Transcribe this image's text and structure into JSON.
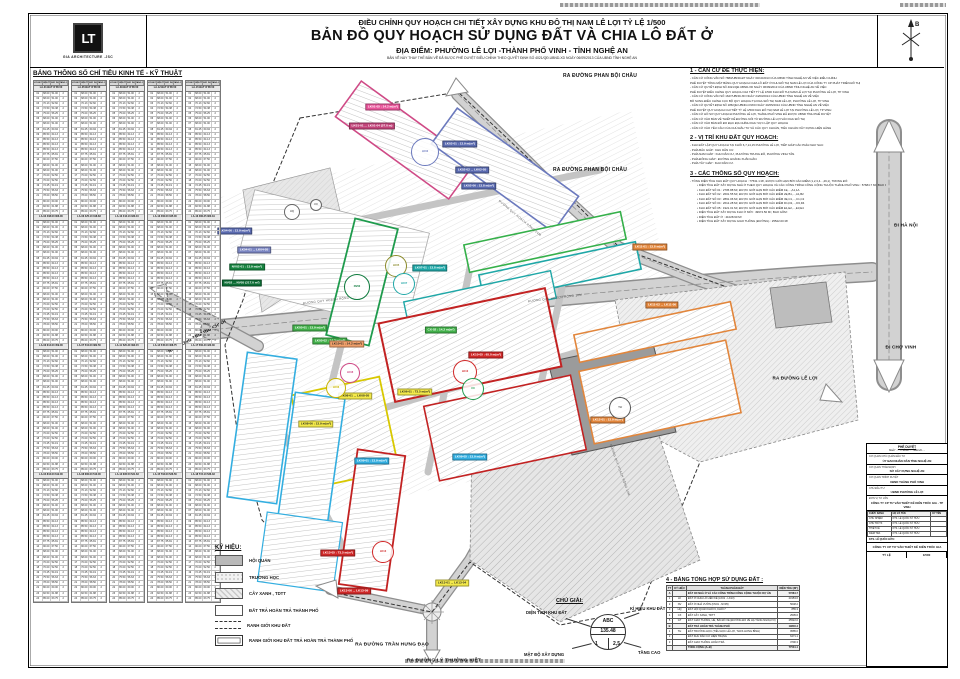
{
  "header": {
    "line1": "ĐIỀU CHỈNH QUY HOẠCH CHI TIẾT XÂY DỰNG KHU ĐÔ THỊ NAM LÊ LỢI TỶ LỆ 1/500",
    "line2": "BẢN ĐỒ QUY HOẠCH SỬ DỤNG ĐẤT VÀ CHIA LÔ ĐẤT Ở",
    "line3": "ĐỊA ĐIỂM: PHƯỜNG LÊ LỢI -THÀNH PHỐ VINH - TỈNH NGHỆ AN",
    "line4": "BẢN VẼ NÀY THAY THẾ BẢN VẼ ĐÃ ĐƯỢC PHÊ DUYỆT ĐIỀU CHỈNH THEO QUYẾT ĐỊNH SỐ 4021/QĐ.UBND-XD NGÀY 06/09/2013 CỦA UBND TỈNH NGHỆ AN"
  },
  "logo": {
    "glyph": "LT",
    "company": "GIA ARCHITECTURE .JSC"
  },
  "compass": {
    "north": "B"
  },
  "left_table": {
    "title": "BẢNG THÔNG SỐ CHỈ TIÊU KINH TẾ - KỸ THUẬT",
    "col_headers": [
      "LÔ ĐẤT",
      "DIỆN TÍCH (M²)",
      "XÂY DỰNG (M²)",
      "TẦNG CAO"
    ],
    "groups": [
      {
        "head": "LA-01 ĐẤT Ở 85.50",
        "subs": [
          "LA-02   408.00   306.00",
          "LA-03   612.00   459.00",
          "LA-04   816.00   612.00"
        ]
      },
      {
        "head": "LA-05 ĐẤT Ở 85.50",
        "subs": [
          "LA-06   425.10   318.83",
          "LA-07   510.00   382.50",
          "LA-08   680.00   510.00"
        ]
      },
      {
        "head": "LA-09 ĐẤT Ở 85.50",
        "subs": [
          "LA-10   444.13   333.10",
          "LA-11   520.20   390.15",
          "LA-12   695.50   521.63"
        ]
      },
      {
        "head": "LA-12 ĐẤT Ở 85.50",
        "subs": [
          "LA-13   460.00   345.00",
          "LA-14   545.00   408.75",
          "LA-15   702.00   526.50"
        ]
      },
      {
        "head": "LA-15 ĐẤT Ở 85.50",
        "subs": [
          "LA-16   480.25   360.19",
          "LA-17   560.40   420.30",
          "LA-18   715.10   536.33"
        ]
      }
    ],
    "rows": [
      [
        "01",
        "68.00",
        "51.00",
        "2"
      ],
      [
        "02",
        "68.00",
        "51.00",
        "2"
      ],
      [
        "03",
        "70.13",
        "52.60",
        "2"
      ],
      [
        "04",
        "72.50",
        "54.38",
        "2"
      ],
      [
        "05",
        "75.00",
        "56.25",
        "2"
      ],
      [
        "06",
        "68.00",
        "51.00",
        "2"
      ],
      [
        "07",
        "68.00",
        "51.00",
        "2"
      ],
      [
        "08",
        "81.25",
        "60.94",
        "2"
      ],
      [
        "09",
        "85.50",
        "64.13",
        "2"
      ],
      [
        "10",
        "85.50",
        "64.13",
        "2"
      ],
      [
        "11",
        "85.50",
        "64.13",
        "2"
      ],
      [
        "12",
        "85.50",
        "64.13",
        "2"
      ],
      [
        "13",
        "87.75",
        "65.81",
        "2"
      ],
      [
        "14",
        "90.00",
        "67.50",
        "2"
      ],
      [
        "15",
        "68.00",
        "51.00",
        "2"
      ],
      [
        "16",
        "68.00",
        "51.00",
        "2"
      ],
      [
        "17",
        "70.00",
        "52.50",
        "2"
      ],
      [
        "18",
        "70.00",
        "52.50",
        "2"
      ],
      [
        "19",
        "72.25",
        "54.19",
        "2"
      ],
      [
        "20",
        "75.50",
        "56.63",
        "2"
      ],
      [
        "21",
        "78.00",
        "58.50",
        "2"
      ],
      [
        "22",
        "80.00",
        "60.00",
        "2"
      ],
      [
        "23",
        "82.50",
        "61.88",
        "2"
      ],
      [
        "24",
        "85.00",
        "63.75",
        "2"
      ]
    ]
  },
  "notes": {
    "sections": [
      {
        "title": "1 - CĂN CỨ ĐỂ THỰC HIỆN:",
        "lines": [
          "- CĂN CỨ CÔNG VĂN SỐ 7883/UBND-ĐT NGÀY 30/10/2013 CỦA UBND TỈNH NGHỆ AN VỀ VIỆC ĐIỀU CHỈNH",
          "PHÊ DUYỆT TỔNG MẶT BẰNG QUY HOẠCH CHIA LÔ ĐẤT Ở KHU ĐÔ THỊ NAM LÊ LỢI CỦA CÔNG TY CP PHÁT TRIỂN ĐÔ THỊ",
          "- CĂN CỨ QUYẾT ĐỊNH SỐ 4021/QĐ.UBND-XD NGÀY 06/09/2013 CỦA UBND TỈNH NGHỆ AN VỀ VIỆC",
          "PHÊ DUYỆT ĐIỀU CHỈNH QUY HOẠCH CHI TIẾT TỶ LỆ 1/500 KHU ĐÔ THỊ NAM LÊ LỢI TẠI PHƯỜNG LÊ LỢI, TP VINH",
          "- CĂN CỨ CÔNG VĂN SỐ 1627/UBND-XD NGÀY 24/03/2014 CỦA UBND TỈNH NGHỆ AN VỀ VIỆC",
          "BỔ SUNG ĐIỀU CHỈNH CỤC BỘ QUY HOẠCH TẠI KHU ĐÔ THỊ NAM LÊ LỢI, PHƯỜNG LÊ LỢI, TP VINH",
          "- CĂN CỨ QUYẾT ĐỊNH SỐ 186/QĐ.UBND-CNXD NGÀY 20/05/2014 CỦA UBND TỈNH NGHỆ AN VỀ VIỆC",
          "PHÊ DUYỆT QUY HOẠCH CHI TIẾT TỶ LỆ 1/500 KHU ĐÔ THỊ NAM LÊ LỢI TẠI PHƯỜNG LÊ LỢI, TP VINH",
          "- CĂN CỨ HỒ SƠ QUY HOẠCH PHƯỜNG LÊ LỢI, THÀNH PHỐ VINH ĐÃ ĐƯỢC UBND TỈNH PHÊ DUYỆT",
          "- CĂN CỨ VÀO BẢN VẼ THIẾT KẾ ĐƯỜNG NỐI TỪ ĐƯỜNG LÊ LỢI VÀO KHU ĐÔ THỊ",
          "- CĂN CỨ VÀO BẢN ĐỒ ĐO ĐẠC ĐỊA CHÍNH KHU VỰC LẬP QUY HOẠCH",
          "- CĂN CỨ VÀO YÊU CẦU CỦA CHỦ ĐẦU TƯ VÀ CÁC QUY CHUẨN, TIÊU CHUẨN XÂY DỰNG HIỆN HÀNH"
        ]
      },
      {
        "title": "2 - VỊ TRÍ KHU ĐẤT QUY HOẠCH:",
        "lines": [
          "- KHU ĐẤT LẬP QUY HOẠCH TẠI KHỐI 6,7,14,15 PHƯỜNG LÊ LỢI, TIẾP GIÁP CÁC PHÍA NHƯ SAU:",
          "- PHÍA BẮC GIÁP : KHU DÂN CƯ.",
          "- PHÍA NAM GIÁP : KHU DÂN CƯ, PHƯỜNG TRUNG ĐÔ, PHƯỜNG VINH TÂN.",
          "- PHÍA ĐÔNG GIÁP : ĐƯỜNG HOÀNG XUÂN HÃN.",
          "- PHÍA TÂY GIÁP : KHU DÂN CƯ."
        ]
      },
      {
        "title": "3 - CÁC THÔNG SỐ QUY HOẠCH:",
        "lines": [
          "- TỔNG DIỆN TÍCH KHU ĐẤT QUY HOẠCH : 77531.1 M², ĐƯỢC GIỚI HẠN BỞI CÁC ĐIỂM (1,2,3,4...,49,1), TRONG ĐÓ:",
          "• DIỆN TÍCH ĐẤT XÂY DỰNG NHÀ Ở THEO QUY HOẠCH VÀ CÁC CÔNG TRÌNH CÔNG CỘNG THUỘC THÀNH PHỐ VINH : 57684.7 M², BAO GỒM 26 KHU ĐẤT:",
          "• KHU ĐẤT SỐ 01 : 2705.88 M², ĐƯỢC GIỚI HẠN BỞI CÁC ĐIỂM 1E,...,A1,1A",
          "• KHU ĐẤT SỐ 02 : 2601.55 M², ĐƯỢC GIỚI HẠN BỞI CÁC ĐIỂM 2E,B1,...,A1,B2",
          "• KHU ĐẤT SỐ 03 : 2891.06 M², ĐƯỢC GIỚI HẠN BỞI CÁC ĐIỂM 3E,C1,...,C1,C2",
          "• KHU ĐẤT SỐ 04 : 2612.28 M², ĐƯỢC GIỚI HẠN BỞI CÁC ĐIỂM D1,D2,...,D3,D4",
          "• KHU ĐẤT SỐ 05 : 1921.01 M², ĐƯỢC GIỚI HẠN BỞI CÁC ĐIỂM E1,E2,...,E3,E4",
          "• DIỆN TÍCH ĐẤT XÂY DỰNG KHU Ở MỚI : 49974.50 M², BAO GỒM:",
          "• DIỆN TÍCH ĐẤT Ở : 41028.90 M²",
          "• DIỆN TÍCH ĐẤT XÂY DỰNG GIAO THÔNG (ĐƯỜNG) : 25522.00 M²"
        ]
      }
    ]
  },
  "legend": {
    "title": "KÝ HIỆU:",
    "items": [
      {
        "style": "solid",
        "label": "HỘI QUÁN"
      },
      {
        "style": "dots",
        "label": "TRƯỜNG HỌC"
      },
      {
        "style": "hatch",
        "label": "CÂY XANH , TDTT"
      },
      {
        "style": "plain",
        "label": "ĐẤT TRẢ HOÀN TRẢ THÀNH PHỐ"
      },
      {
        "style": "dashed",
        "label": "RANH GIỚI KHU ĐẤT"
      },
      {
        "style": "double",
        "label": "RANH GIỚI KHU ĐẤT TRẢ HOÀN TRẢ THÀNH PHỐ"
      }
    ]
  },
  "chu_giai": {
    "title": "CHÚ GIẢI:",
    "circle": {
      "top": "ABC",
      "mid": "135.48",
      "bl": "1",
      "br": "2,5"
    },
    "labels": {
      "tl": "DIỆN TÍCH KHU ĐẤT",
      "tr": "KÍ HIỆU KHU ĐẤT",
      "bl": "MẬT ĐỘ XÂY DỰNG",
      "br": "TẦNG CAO"
    }
  },
  "summary_table": {
    "title": "4 - BẢNG TỔNG HỢP SỬ DỤNG ĐẤT :",
    "headers": [
      "TT",
      "KÝ HIỆU",
      "THÀNH PHẦN ĐẤT",
      "DIỆN TÍCH (M²)"
    ],
    "rows": [
      {
        "grp": true,
        "c": [
          "A",
          "",
          "ĐẤT XD NHÀ Ở VÀ CÁC CÔNG TRÌNH CÔNG CỘNG THUỘC DỰ ÁN",
          "57684.7"
        ]
      },
      {
        "grp": false,
        "c": [
          "1",
          "LK",
          "ĐẤT Ở CHIA LÔ LIỀN KỀ (LK01 - LK13)",
          "23153.6"
        ]
      },
      {
        "grp": false,
        "c": [
          "2",
          "NV",
          "ĐẤT Ở NHÀ VƯỜN (NV01 - NV05)",
          "5648.2"
        ]
      },
      {
        "grp": false,
        "c": [
          "3",
          "HQ",
          "ĐẤT HỘI QUÁN KHỐI 6, KHỐI 7",
          "855.3"
        ]
      },
      {
        "grp": false,
        "c": [
          "4",
          "CX",
          "ĐẤT CÂY XANH, TDTT",
          "2505.6"
        ]
      },
      {
        "grp": false,
        "c": [
          "5",
          "GT",
          "ĐẤT GIAO THÔNG, HÈ, BÃI ĐỖ XE (ĐƯỜNG ĐỎ VỀ HẠ TẦNG NGOẠI VI)",
          "25522.0"
        ]
      },
      {
        "grp": true,
        "c": [
          "B",
          "",
          "ĐẤT TRẢ HOÀN TRẢ THÀNH PHỐ",
          "19846.4"
        ]
      },
      {
        "grp": false,
        "c": [
          "1",
          "TH",
          "ĐẤT TRƯỜNG HỌC (TIỂU HỌC LÊ LỢI, THCS HƯNG BÌNH)",
          "9585.0"
        ]
      },
      {
        "grp": false,
        "c": [
          "2",
          "",
          "ĐẤT KHU DÂN CƯ HIỆN TRẠNG",
          "6471.1"
        ]
      },
      {
        "grp": false,
        "c": [
          "3",
          "",
          "ĐẤT GIAO THÔNG HOÀN TRẢ",
          "3790.3"
        ]
      },
      {
        "grp": true,
        "c": [
          "",
          "",
          "TỔNG CỘNG (A+B)",
          "77531.1"
        ]
      }
    ]
  },
  "title_block": {
    "stamp": "PHÊ DUYỆT",
    "stamp_sub": "NGÀY ..... THÁNG ..... NĂM 20.....",
    "rows": [
      {
        "label": "CƠ QUAN CHỦ QUẢN ĐẦU TƯ",
        "value": "ỦY BAN NHÂN DÂN TỈNH NGHỆ AN"
      },
      {
        "label": "CƠ QUAN THẨM ĐỊNH",
        "value": "SỞ XÂY DỰNG NGHỆ AN"
      },
      {
        "label": "CƠ QUAN TRÌNH DUYỆT",
        "value": "UBND THÀNH PHỐ VINH"
      },
      {
        "label": "CHỦ ĐẦU TƯ",
        "value": "UBND PHƯỜNG LÊ LỢI"
      },
      {
        "label": "ĐƠN VỊ TƯ VẤN",
        "value": "CÔNG TY CP TƯ VẤN THIẾT KẾ KIẾN TRÚC GIA - TP VINH"
      }
    ],
    "sig_headers": [
      "CHỨC DANH",
      "HỌ VÀ TÊN",
      "KÝ TÊN"
    ],
    "sig_rows": [
      [
        "CHỦ NHIỆM",
        "KTS. LÊ QUỐC SỸ HỮU",
        ""
      ],
      [
        "CHỦ TRÌ TK",
        "KTS. LÊ QUỐC SỸ HỮU",
        ""
      ],
      [
        "THIẾT KẾ",
        "KTS. LÊ QUỐC SỸ HỮU",
        ""
      ],
      [
        "KIỂM TRA",
        "KTS. LÊ QUỐC SỸ HỮU",
        ""
      ]
    ],
    "note": "KTS. LÊ QUỐC HỮU:",
    "company": "CÔNG TY CP TƯ VẤN THIẾT KẾ KIẾN TRÚC GIA",
    "scale_label": "TỶ LỆ",
    "scale": "1/500"
  },
  "map": {
    "road_labels": [
      {
        "text": "RA ĐƯỜNG PHAN BỘI CHÂU",
        "x": 600,
        "y": 76,
        "rot": 0,
        "size": 5
      },
      {
        "text": "RA ĐƯỜNG PHAN BỘI CHÂU",
        "x": 590,
        "y": 170,
        "rot": 0,
        "size": 5
      },
      {
        "text": "ĐI HÀ NỘI",
        "x": 906,
        "y": 225,
        "rot": 0,
        "size": 4.6
      },
      {
        "text": "ĐI CHỢ VINH",
        "x": 901,
        "y": 347,
        "rot": 0,
        "size": 4.6
      },
      {
        "text": "RA ĐƯỜNG LÊ LỢI",
        "x": 795,
        "y": 378,
        "rot": 0,
        "size": 4.6
      },
      {
        "text": "RA ĐƯỜNG TRƯỜNG CHINH",
        "x": 197,
        "y": 336,
        "rot": -28,
        "size": 4.4
      },
      {
        "text": "RA ĐƯỜNG TRẦN HƯNG ĐẠO",
        "x": 392,
        "y": 645,
        "rot": 0,
        "size": 4.8
      },
      {
        "text": "RA ĐƯỜNG LÝ THƯỜNG KIỆT",
        "x": 444,
        "y": 661,
        "rot": 0,
        "size": 4.8
      }
    ],
    "street_names": [
      {
        "text": "ĐƯỜNG QUY HOẠCH RỘNG 24M",
        "x": 520,
        "y": 218,
        "rot": 40
      },
      {
        "text": "ĐƯỜNG QUY HOẠCH RỘNG 16M",
        "x": 555,
        "y": 298,
        "rot": -7
      },
      {
        "text": "ĐƯỜNG QUY HOẠCH RỘNG 12M",
        "x": 330,
        "y": 300,
        "rot": -7
      },
      {
        "text": "ĐƯỜNG QUY HOẠCH RỘNG 12M",
        "x": 620,
        "y": 470,
        "rot": 70
      }
    ],
    "callouts": [
      {
        "text": "LK01-05 : 14.2 m(m²)",
        "x": 383,
        "y": 107,
        "bg": "#e8559a",
        "fg": "#fff"
      },
      {
        "text": "LK01-01 ... LK01-04 (57.0 m)",
        "x": 372,
        "y": 126,
        "bg": "#c2447a",
        "fg": "#fff"
      },
      {
        "text": "LK02-01 : 13.9 m(m²)",
        "x": 460,
        "y": 144,
        "bg": "#5a6ab0",
        "fg": "#fff"
      },
      {
        "text": "LK02-02 ... LK02-05",
        "x": 472,
        "y": 170,
        "bg": "#5a6ab0",
        "fg": "#fff"
      },
      {
        "text": "LK02-06 : 13.8 m(m²)",
        "x": 479,
        "y": 186,
        "bg": "#5a6ab0",
        "fg": "#fff"
      },
      {
        "text": "LK04-06 : 13.9 m(m²)",
        "x": 235,
        "y": 231,
        "bg": "#5a6ab0",
        "fg": "#fff"
      },
      {
        "text": "LK04-01 ... LK04-05",
        "x": 254,
        "y": 250,
        "bg": "#7b86c2",
        "fg": "#fff"
      },
      {
        "text": "NV02-01 : 13.9 m(m²)",
        "x": 247,
        "y": 267,
        "bg": "#16833f",
        "fg": "#fff"
      },
      {
        "text": "NV02 ... NV05 (217.0 m²)",
        "x": 242,
        "y": 283,
        "bg": "#0d6e35",
        "fg": "#fff"
      },
      {
        "text": "LK05-01 : 13.9 m(m²)",
        "x": 310,
        "y": 328,
        "bg": "#42b04a",
        "fg": "#fff"
      },
      {
        "text": "LK05-02 : 14.2 m(m²)",
        "x": 330,
        "y": 341,
        "bg": "#42b04a",
        "fg": "#fff"
      },
      {
        "text": "LK07-01 : 13.8 m(m²)",
        "x": 430,
        "y": 268,
        "bg": "#1fa7a7",
        "fg": "#fff"
      },
      {
        "text": "LK09-01 : 13.9 m(m²)",
        "x": 372,
        "y": 461,
        "bg": "#33aee0",
        "fg": "#fff"
      },
      {
        "text": "LK09-05 : 13.9 m(m²)",
        "x": 470,
        "y": 457,
        "bg": "#33aee0",
        "fg": "#fff"
      },
      {
        "text": "LK08-01 ... LK08-05",
        "x": 355,
        "y": 396,
        "bg": "#f3e94a",
        "fg": "#222"
      },
      {
        "text": "LK08-06 : 13.9 m(m²)",
        "x": 316,
        "y": 424,
        "bg": "#f3e94a",
        "fg": "#222"
      },
      {
        "text": "LK06-01 : 73.5 m(m²)",
        "x": 415,
        "y": 392,
        "bg": "#f3e94a",
        "fg": "#222"
      },
      {
        "text": "LK13-01 ... LK13-04",
        "x": 452,
        "y": 583,
        "bg": "#f3e94a",
        "fg": "#222"
      },
      {
        "text": "LK10-01 : 14.2 m(m²)",
        "x": 347,
        "y": 344,
        "bg": "#f0a06a",
        "fg": "#222"
      },
      {
        "text": "LK11-01 : 13.8 m(m²)",
        "x": 650,
        "y": 247,
        "bg": "#e2863c",
        "fg": "#fff"
      },
      {
        "text": "LK11-02 ... LK11-06",
        "x": 662,
        "y": 305,
        "bg": "#e2863c",
        "fg": "#fff"
      },
      {
        "text": "LK12-01 : 13.9 m(m²)",
        "x": 608,
        "y": 420,
        "bg": "#e2863c",
        "fg": "#fff"
      },
      {
        "text": "LK10-05 : 65.0 m(m²)",
        "x": 486,
        "y": 355,
        "bg": "#d02828",
        "fg": "#fff"
      },
      {
        "text": "LK13-05 : 73.5 m(m²)",
        "x": 338,
        "y": 553,
        "bg": "#d02828",
        "fg": "#fff"
      },
      {
        "text": "LK13-06 ... LK13-09",
        "x": 354,
        "y": 591,
        "bg": "#d02828",
        "fg": "#fff"
      },
      {
        "text": "CX-02 : 14.2 m(m²)",
        "x": 441,
        "y": 330,
        "bg": "#42b04a",
        "fg": "#fff"
      }
    ],
    "circles": [
      {
        "x": 425,
        "y": 152,
        "r": 13,
        "color": "#6b79bd",
        "text": "LK02"
      },
      {
        "x": 357,
        "y": 287,
        "r": 12,
        "color": "#0d7a3c",
        "text": "NV02"
      },
      {
        "x": 396,
        "y": 266,
        "r": 10,
        "color": "#8a8a2a",
        "text": "LK05"
      },
      {
        "x": 404,
        "y": 284,
        "r": 10,
        "color": "#1fa7a7",
        "text": "LK07"
      },
      {
        "x": 465,
        "y": 372,
        "r": 11,
        "color": "#d02828",
        "text": "LK10"
      },
      {
        "x": 473,
        "y": 389,
        "r": 10,
        "color": "#1f9b4d",
        "text": "CX"
      },
      {
        "x": 350,
        "y": 373,
        "r": 9,
        "color": "#cf4a86",
        "text": "LK08"
      },
      {
        "x": 336,
        "y": 388,
        "r": 9,
        "color": "#c8b400",
        "text": "LK06"
      },
      {
        "x": 620,
        "y": 408,
        "r": 10,
        "color": "#555555",
        "text": "TH"
      },
      {
        "x": 383,
        "y": 552,
        "r": 10,
        "color": "#d02828",
        "text": "LK13"
      },
      {
        "x": 292,
        "y": 212,
        "r": 7,
        "color": "#666666",
        "text": "HQ"
      },
      {
        "x": 316,
        "y": 205,
        "r": 5,
        "color": "#666666",
        "text": "CX"
      }
    ]
  }
}
